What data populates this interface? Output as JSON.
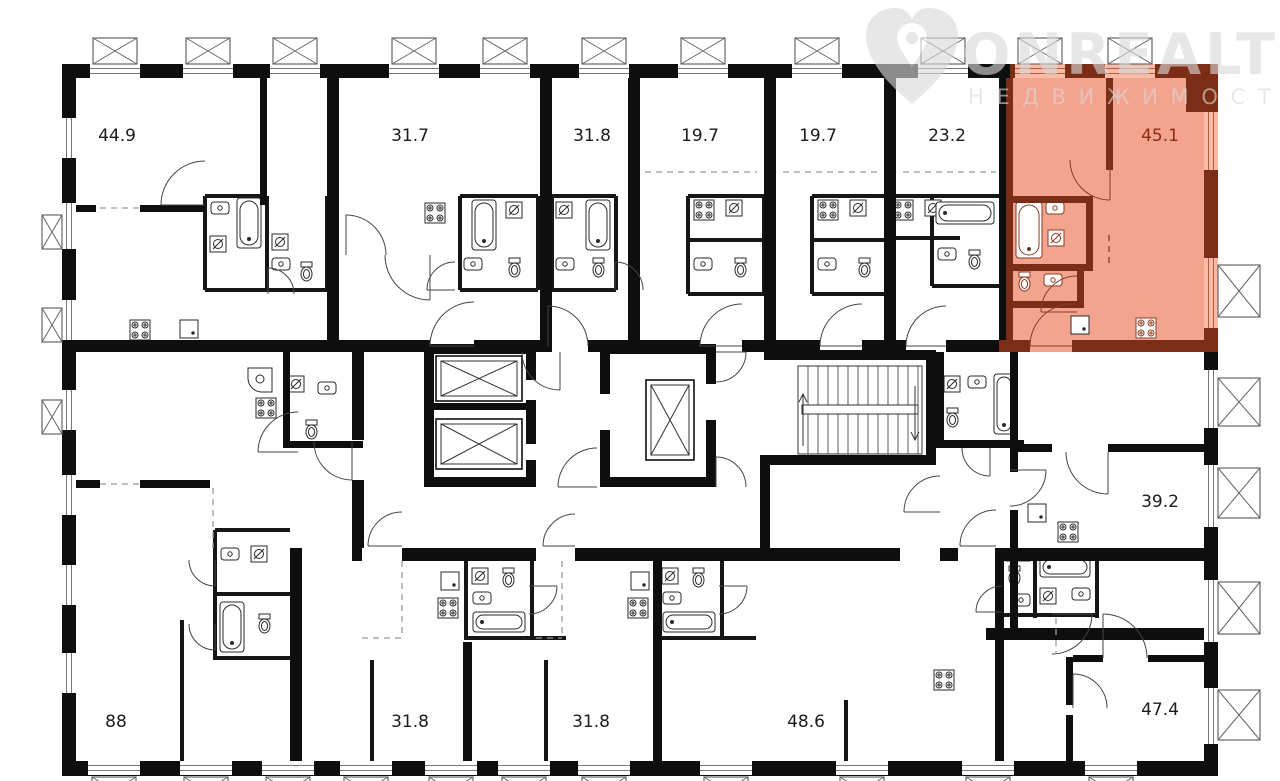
{
  "watermark": {
    "brand": "ONREALT",
    "tagline": "Н Е Д В И Ж И М О С Т Ь"
  },
  "units": [
    {
      "id": "unit-44-9",
      "area": "44.9",
      "x": 117,
      "y": 136,
      "highlighted": false
    },
    {
      "id": "unit-31-7",
      "area": "31.7",
      "x": 410,
      "y": 136,
      "highlighted": false
    },
    {
      "id": "unit-31-8-top",
      "area": "31.8",
      "x": 592,
      "y": 136,
      "highlighted": false
    },
    {
      "id": "unit-19-7-a",
      "area": "19.7",
      "x": 700,
      "y": 136,
      "highlighted": false
    },
    {
      "id": "unit-19-7-b",
      "area": "19.7",
      "x": 818,
      "y": 136,
      "highlighted": false
    },
    {
      "id": "unit-23-2",
      "area": "23.2",
      "x": 947,
      "y": 136,
      "highlighted": false
    },
    {
      "id": "unit-45-1",
      "area": "45.1",
      "x": 1160,
      "y": 136,
      "highlighted": true
    },
    {
      "id": "unit-39-2",
      "area": "39.2",
      "x": 1160,
      "y": 502,
      "highlighted": false
    },
    {
      "id": "unit-88",
      "area": "88",
      "x": 116,
      "y": 722,
      "highlighted": false
    },
    {
      "id": "unit-31-8-bottom-a",
      "area": "31.8",
      "x": 410,
      "y": 722,
      "highlighted": false
    },
    {
      "id": "unit-31-8-bottom-b",
      "area": "31.8",
      "x": 591,
      "y": 722,
      "highlighted": false
    },
    {
      "id": "unit-48-6",
      "area": "48.6",
      "x": 806,
      "y": 722,
      "highlighted": false
    },
    {
      "id": "unit-47-4",
      "area": "47.4",
      "x": 1160,
      "y": 710,
      "highlighted": false
    }
  ],
  "colors": {
    "wall": "#0e0e0e",
    "thin_wall": "#161616",
    "fixture": "#2a2a2a",
    "highlight_fill": "#f4a48e",
    "highlight_wall": "#7c2d15",
    "highlight_fixture": "#8a3a20",
    "highlight_window": "#f7bba8",
    "label": "#1b1b1b",
    "highlight_label": "#8c2c10",
    "watermark": "#d9d9d9",
    "window_line": "#777777",
    "vent_box_line": "#666666"
  }
}
